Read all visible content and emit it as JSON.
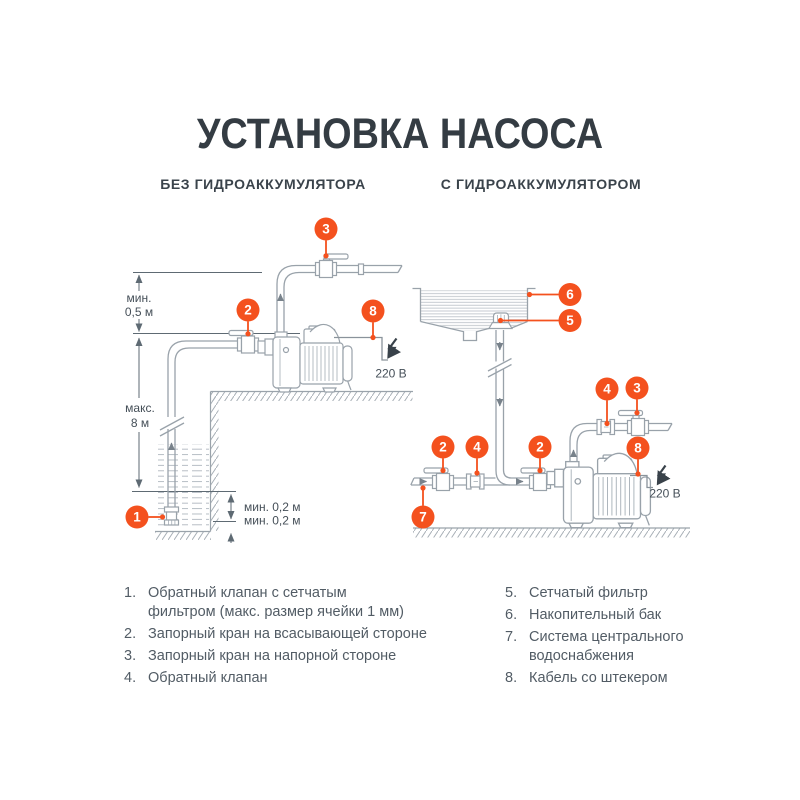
{
  "header": {
    "title": "УСТАНОВКА НАСОСА",
    "subtitle_left": "БЕЗ ГИДРОАККУМУЛЯТОРА",
    "subtitle_right": "С ГИДРОАККУМУЛЯТОРОМ"
  },
  "colors": {
    "accent_orange": "#f4511e",
    "line_gray": "#99a2aa",
    "dimension_gray": "#5e6a73",
    "text_dark": "#343c43"
  },
  "markers": {
    "n1": "1",
    "n2": "2",
    "n3": "3",
    "n4": "4",
    "n5": "5",
    "n6": "6",
    "n7": "7",
    "n8": "8"
  },
  "dimensions": {
    "min_05_line1": "мин.",
    "min_05_line2": "0,5 м",
    "max_8_line1": "макс.",
    "max_8_line2": "8 м",
    "min_02_upper": "мин. 0,2 м",
    "min_02_lower": "мин. 0,2 м",
    "voltage": "220 В"
  },
  "legend": {
    "left": [
      {
        "num": "1.",
        "text": "Обратный клапан с сетчатым\nфильтром (макс. размер ячейки 1 мм)"
      },
      {
        "num": "2.",
        "text": "Запорный кран на всасывающей стороне"
      },
      {
        "num": "3.",
        "text": "Запорный кран на напорной стороне"
      },
      {
        "num": "4.",
        "text": "Обратный клапан"
      }
    ],
    "right": [
      {
        "num": "5.",
        "text": "Сетчатый фильтр"
      },
      {
        "num": "6.",
        "text": "Накопительный бак"
      },
      {
        "num": "7.",
        "text": "Система центрального\nводоснабжения"
      },
      {
        "num": "8.",
        "text": "Кабель со штекером"
      }
    ]
  }
}
